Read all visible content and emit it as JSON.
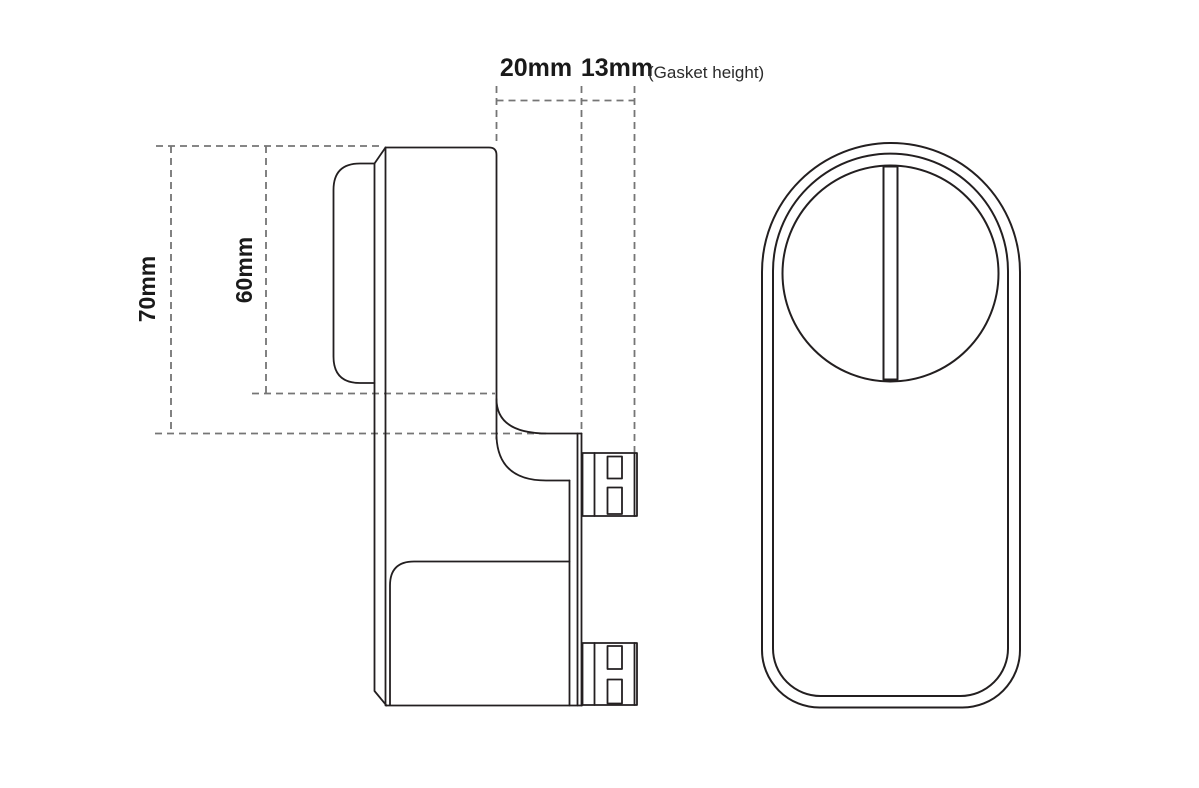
{
  "diagram": {
    "dims": {
      "outer_height": "70mm",
      "inner_height": "60mm",
      "body_depth": "20mm",
      "gasket_depth": "13mm",
      "gasket_note": "(Gasket height)"
    },
    "colors": {
      "line": "#231f20",
      "dash": "#757575",
      "background": "#ffffff",
      "text": "#1a1a1a"
    }
  }
}
